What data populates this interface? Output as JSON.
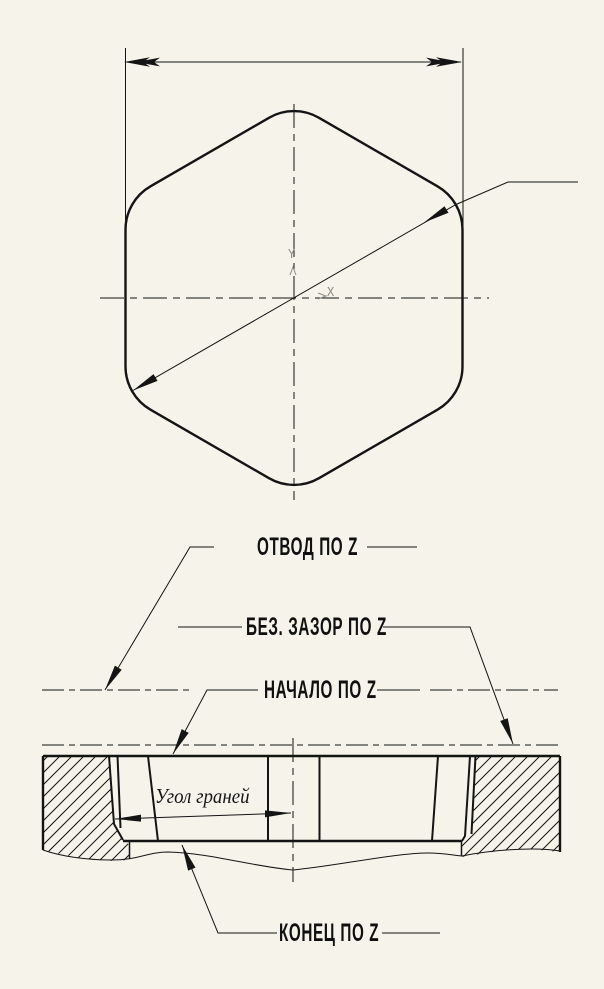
{
  "colors": {
    "background": "#f5f3ea",
    "line": "#141414",
    "axis_marker": "#8d8d85"
  },
  "top_view": {
    "axis_marker": {
      "x_label": "X",
      "y_label": "Y"
    }
  },
  "section_view": {
    "callouts": {
      "retract_z": "ОТВОД ПО Z",
      "safe_clearance_z": "БЕЗ. ЗАЗОР ПО Z",
      "start_z": "НАЧАЛО ПО Z",
      "face_angle": "Угол граней",
      "end_z": "КОНЕЦ ПО Z"
    }
  }
}
